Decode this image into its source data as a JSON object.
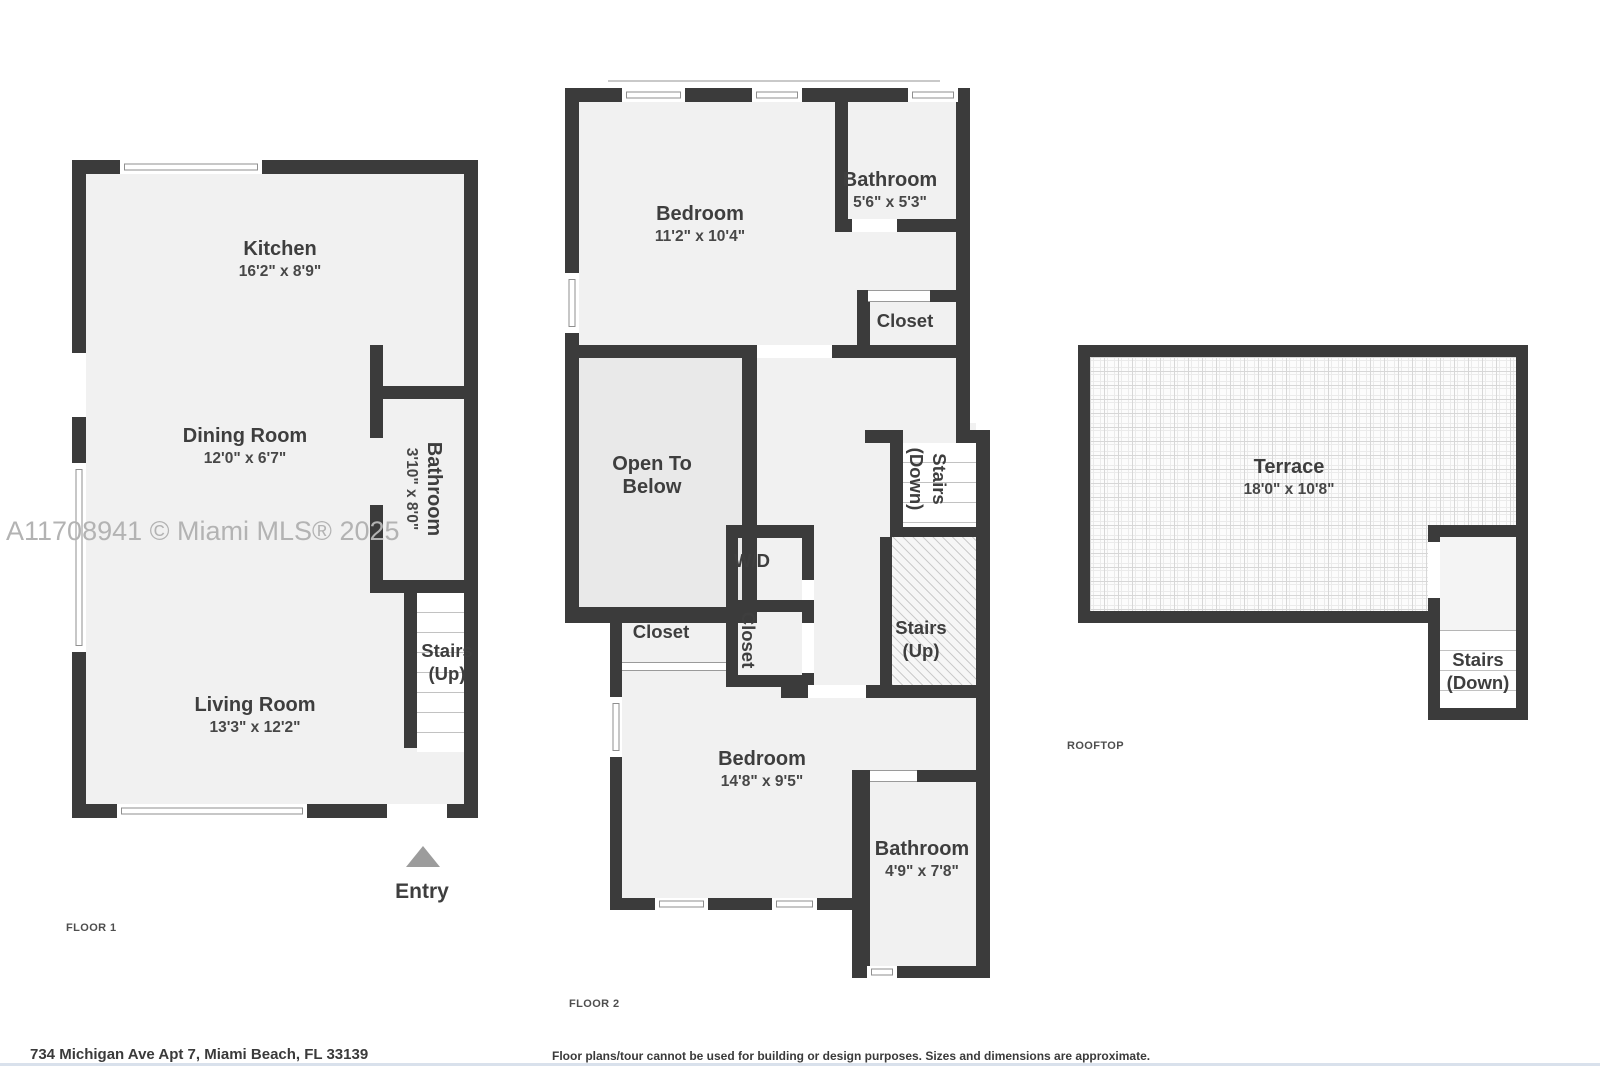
{
  "watermark": "A11708941 © Miami MLS® 2025",
  "colors": {
    "wall": "#3b3b3b",
    "room_fill": "#f1f1f1",
    "open_to_below_fill": "#e9e9e9",
    "entry_arrow": "#9c9c9c",
    "watermark_text": "#b3b3b3"
  },
  "floor1": {
    "label": "FLOOR 1",
    "kitchen": {
      "name": "Kitchen",
      "dims": "16'2\" x 8'9\""
    },
    "dining": {
      "name": "Dining Room",
      "dims": "12'0\" x 6'7\""
    },
    "living": {
      "name": "Living Room",
      "dims": "13'3\" x 12'2\""
    },
    "bathroom": {
      "name": "Bathroom",
      "dims": "3'10\" x 8'0\""
    },
    "stairs_up": {
      "l1": "Stairs",
      "l2": "(Up)"
    },
    "entry": "Entry"
  },
  "floor2": {
    "label": "FLOOR 2",
    "bedroom_top": {
      "name": "Bedroom",
      "dims": "11'2\" x 10'4\""
    },
    "bathroom_top": {
      "name": "Bathroom",
      "dims": "5'6\" x 5'3\""
    },
    "closet_top": {
      "name": "Closet"
    },
    "open_to_below": {
      "l1": "Open To",
      "l2": "Below"
    },
    "wd": {
      "name": "W/D"
    },
    "closet_mid": {
      "name": "Closet"
    },
    "closet_small": {
      "name": "Closet"
    },
    "stairs_down": {
      "l1": "Stairs",
      "l2": "(Down)"
    },
    "stairs_up": {
      "l1": "Stairs",
      "l2": "(Up)"
    },
    "bedroom_bottom": {
      "name": "Bedroom",
      "dims": "14'8\" x 9'5\""
    },
    "bathroom_bottom": {
      "name": "Bathroom",
      "dims": "4'9\" x 7'8\""
    }
  },
  "rooftop": {
    "label": "ROOFTOP",
    "terrace": {
      "name": "Terrace",
      "dims": "18'0\" x 10'8\""
    },
    "stairs_down": {
      "l1": "Stairs",
      "l2": "(Down)"
    }
  },
  "footer": {
    "address": "734 Michigan Ave Apt 7, Miami Beach, FL 33139",
    "disclaimer": "Floor plans/tour cannot be used for building or design purposes. Sizes and dimensions are approximate."
  }
}
